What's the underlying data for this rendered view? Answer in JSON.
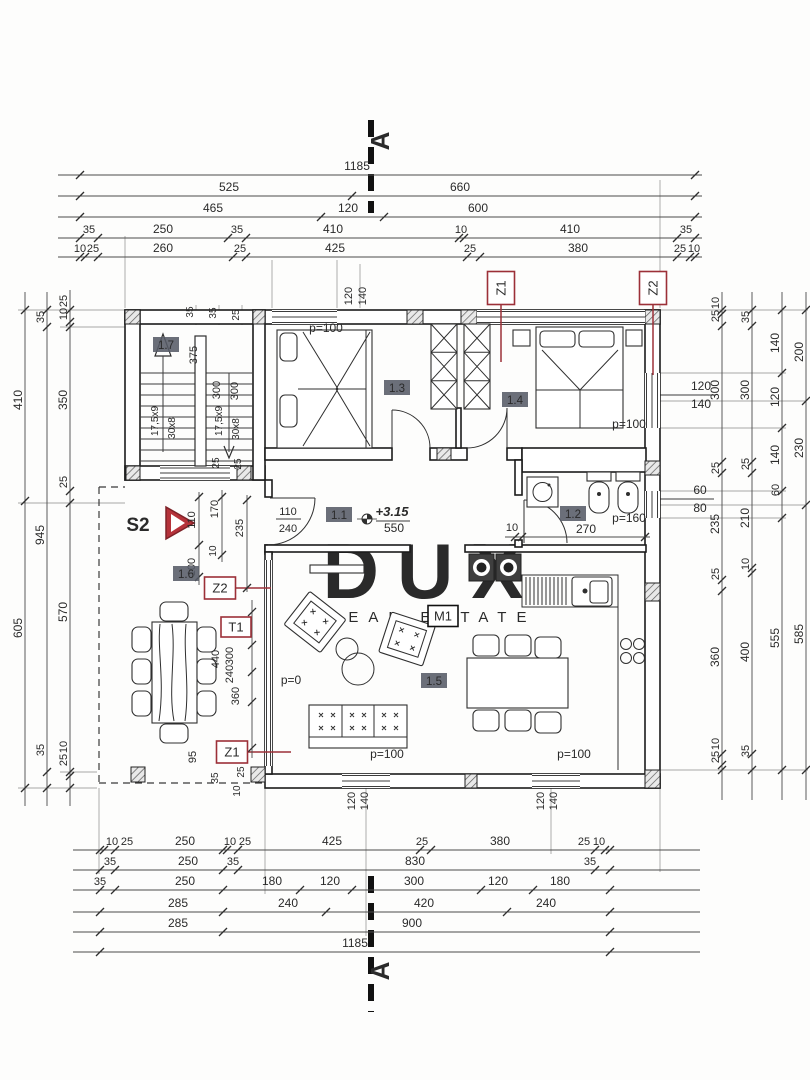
{
  "watermark": {
    "line1": "DUX",
    "line2": "REAL ESTATE"
  },
  "colors": {
    "red": "#9c3038",
    "badge_bg": "#565b66",
    "wall": "#1c1c1c"
  },
  "section_marker": "A",
  "rooms": [
    {
      "id": "1.7",
      "x": 166,
      "y": 348
    },
    {
      "id": "1.3",
      "x": 397,
      "y": 391
    },
    {
      "id": "1.4",
      "x": 515,
      "y": 403
    },
    {
      "id": "1.1",
      "x": 339,
      "y": 518
    },
    {
      "id": "1.2",
      "x": 573,
      "y": 517
    },
    {
      "id": "1.5",
      "x": 434,
      "y": 684
    },
    {
      "id": "1.6",
      "x": 186,
      "y": 577
    }
  ],
  "marker_boxes": [
    {
      "t": "Z1",
      "x": 501,
      "y": 288,
      "w": 27,
      "h": 33,
      "r": -90,
      "style": "red"
    },
    {
      "t": "Z2",
      "x": 653,
      "y": 288,
      "w": 27,
      "h": 33,
      "r": -90,
      "style": "red"
    },
    {
      "t": "Z2",
      "x": 220,
      "y": 588,
      "w": 31,
      "h": 22,
      "r": 0,
      "style": "red"
    },
    {
      "t": "T1",
      "x": 236,
      "y": 627,
      "w": 30,
      "h": 20,
      "r": 0,
      "style": "red"
    },
    {
      "t": "Z1",
      "x": 232,
      "y": 752,
      "w": 31,
      "h": 22,
      "r": 0,
      "style": "red"
    },
    {
      "t": "M1",
      "x": 443,
      "y": 616,
      "w": 30,
      "h": 21,
      "r": 0,
      "style": "black"
    }
  ],
  "s2_label": "S2",
  "labels": [
    {
      "t": "A",
      "x": 389,
      "y": 141,
      "r": -90,
      "s": 26,
      "b": 1
    },
    {
      "t": "A",
      "x": 389,
      "y": 971,
      "r": -90,
      "s": 26,
      "b": 1
    },
    {
      "t": "1185",
      "x": 357,
      "y": 170,
      "s": 12
    },
    {
      "t": "525",
      "x": 229,
      "y": 191,
      "s": 12
    },
    {
      "t": "660",
      "x": 460,
      "y": 191,
      "s": 12
    },
    {
      "t": "465",
      "x": 213,
      "y": 212,
      "s": 12
    },
    {
      "t": "120",
      "x": 348,
      "y": 212,
      "s": 12
    },
    {
      "t": "600",
      "x": 478,
      "y": 212,
      "s": 12
    },
    {
      "t": "35",
      "x": 89,
      "y": 233,
      "s": 11
    },
    {
      "t": "250",
      "x": 163,
      "y": 233,
      "s": 12
    },
    {
      "t": "35",
      "x": 237,
      "y": 233,
      "s": 11
    },
    {
      "t": "410",
      "x": 333,
      "y": 233,
      "s": 12
    },
    {
      "t": "10",
      "x": 461,
      "y": 233,
      "s": 11
    },
    {
      "t": "410",
      "x": 570,
      "y": 233,
      "s": 12
    },
    {
      "t": "35",
      "x": 686,
      "y": 233,
      "s": 11
    },
    {
      "t": "10",
      "x": 80,
      "y": 252,
      "s": 11
    },
    {
      "t": "25",
      "x": 93,
      "y": 252,
      "s": 11
    },
    {
      "t": "260",
      "x": 163,
      "y": 252,
      "s": 12
    },
    {
      "t": "25",
      "x": 240,
      "y": 252,
      "s": 11
    },
    {
      "t": "425",
      "x": 335,
      "y": 252,
      "s": 12
    },
    {
      "t": "25",
      "x": 470,
      "y": 252,
      "s": 11
    },
    {
      "t": "380",
      "x": 578,
      "y": 252,
      "s": 12
    },
    {
      "t": "25",
      "x": 680,
      "y": 252,
      "s": 11
    },
    {
      "t": "10",
      "x": 694,
      "y": 252,
      "s": 11
    },
    {
      "t": "120",
      "x": 352,
      "y": 296,
      "r": -90,
      "s": 11
    },
    {
      "t": "140",
      "x": 366,
      "y": 296,
      "r": -90,
      "s": 11
    },
    {
      "t": "10",
      "x": 112,
      "y": 845,
      "s": 11
    },
    {
      "t": "25",
      "x": 127,
      "y": 845,
      "s": 11
    },
    {
      "t": "250",
      "x": 185,
      "y": 845,
      "s": 12
    },
    {
      "t": "10",
      "x": 230,
      "y": 845,
      "s": 11
    },
    {
      "t": "25",
      "x": 245,
      "y": 845,
      "s": 11
    },
    {
      "t": "425",
      "x": 332,
      "y": 845,
      "s": 12
    },
    {
      "t": "25",
      "x": 422,
      "y": 845,
      "s": 11
    },
    {
      "t": "380",
      "x": 500,
      "y": 845,
      "s": 12
    },
    {
      "t": "25",
      "x": 584,
      "y": 845,
      "s": 11
    },
    {
      "t": "10",
      "x": 599,
      "y": 845,
      "s": 11
    },
    {
      "t": "35",
      "x": 110,
      "y": 865,
      "s": 11
    },
    {
      "t": "250",
      "x": 188,
      "y": 865,
      "s": 12
    },
    {
      "t": "35",
      "x": 233,
      "y": 865,
      "s": 11
    },
    {
      "t": "830",
      "x": 415,
      "y": 865,
      "s": 12
    },
    {
      "t": "35",
      "x": 590,
      "y": 865,
      "s": 11
    },
    {
      "t": "35",
      "x": 100,
      "y": 885,
      "s": 11
    },
    {
      "t": "250",
      "x": 185,
      "y": 885,
      "s": 12
    },
    {
      "t": "180",
      "x": 272,
      "y": 885,
      "s": 12
    },
    {
      "t": "120",
      "x": 330,
      "y": 885,
      "s": 12
    },
    {
      "t": "300",
      "x": 414,
      "y": 885,
      "s": 12
    },
    {
      "t": "120",
      "x": 498,
      "y": 885,
      "s": 12
    },
    {
      "t": "180",
      "x": 560,
      "y": 885,
      "s": 12
    },
    {
      "t": "285",
      "x": 178,
      "y": 907,
      "s": 12
    },
    {
      "t": "240",
      "x": 288,
      "y": 907,
      "s": 12
    },
    {
      "t": "420",
      "x": 424,
      "y": 907,
      "s": 12
    },
    {
      "t": "240",
      "x": 546,
      "y": 907,
      "s": 12
    },
    {
      "t": "285",
      "x": 178,
      "y": 927,
      "s": 12
    },
    {
      "t": "900",
      "x": 412,
      "y": 927,
      "s": 12
    },
    {
      "t": "1185",
      "x": 355,
      "y": 947,
      "s": 12
    },
    {
      "t": "120",
      "x": 355,
      "y": 801,
      "r": -90,
      "s": 11
    },
    {
      "t": "140",
      "x": 368,
      "y": 801,
      "r": -90,
      "s": 11
    },
    {
      "t": "120",
      "x": 544,
      "y": 801,
      "r": -90,
      "s": 11
    },
    {
      "t": "140",
      "x": 557,
      "y": 801,
      "r": -90,
      "s": 11
    },
    {
      "t": "410",
      "x": 22,
      "y": 400,
      "r": -90,
      "s": 12
    },
    {
      "t": "605",
      "x": 22,
      "y": 628,
      "r": -90,
      "s": 12
    },
    {
      "t": "35",
      "x": 44,
      "y": 317,
      "r": -90,
      "s": 11
    },
    {
      "t": "945",
      "x": 44,
      "y": 535,
      "r": -90,
      "s": 12
    },
    {
      "t": "35",
      "x": 44,
      "y": 750,
      "r": -90,
      "s": 11
    },
    {
      "t": "25",
      "x": 67,
      "y": 301,
      "r": -90,
      "s": 11
    },
    {
      "t": "10",
      "x": 67,
      "y": 314,
      "r": -90,
      "s": 11
    },
    {
      "t": "350",
      "x": 67,
      "y": 400,
      "r": -90,
      "s": 12
    },
    {
      "t": "25",
      "x": 67,
      "y": 482,
      "r": -90,
      "s": 11
    },
    {
      "t": "570",
      "x": 67,
      "y": 612,
      "r": -90,
      "s": 12
    },
    {
      "t": "10",
      "x": 67,
      "y": 747,
      "r": -90,
      "s": 11
    },
    {
      "t": "25",
      "x": 67,
      "y": 760,
      "r": -90,
      "s": 11
    },
    {
      "t": "10",
      "x": 719,
      "y": 303,
      "r": -90,
      "s": 11
    },
    {
      "t": "25",
      "x": 719,
      "y": 316,
      "r": -90,
      "s": 11
    },
    {
      "t": "300",
      "x": 719,
      "y": 390,
      "r": -90,
      "s": 12
    },
    {
      "t": "25",
      "x": 719,
      "y": 468,
      "r": -90,
      "s": 11
    },
    {
      "t": "235",
      "x": 719,
      "y": 524,
      "r": -90,
      "s": 12
    },
    {
      "t": "25",
      "x": 719,
      "y": 574,
      "r": -90,
      "s": 11
    },
    {
      "t": "360",
      "x": 719,
      "y": 657,
      "r": -90,
      "s": 12
    },
    {
      "t": "10",
      "x": 719,
      "y": 744,
      "r": -90,
      "s": 11
    },
    {
      "t": "25",
      "x": 719,
      "y": 757,
      "r": -90,
      "s": 11
    },
    {
      "t": "35",
      "x": 749,
      "y": 317,
      "r": -90,
      "s": 11
    },
    {
      "t": "300",
      "x": 749,
      "y": 390,
      "r": -90,
      "s": 12
    },
    {
      "t": "25",
      "x": 749,
      "y": 464,
      "r": -90,
      "s": 11
    },
    {
      "t": "210",
      "x": 749,
      "y": 518,
      "r": -90,
      "s": 12
    },
    {
      "t": "10",
      "x": 749,
      "y": 564,
      "r": -90,
      "s": 11
    },
    {
      "t": "400",
      "x": 749,
      "y": 652,
      "r": -90,
      "s": 12
    },
    {
      "t": "35",
      "x": 749,
      "y": 751,
      "r": -90,
      "s": 11
    },
    {
      "t": "140",
      "x": 779,
      "y": 343,
      "r": -90,
      "s": 12
    },
    {
      "t": "120",
      "x": 779,
      "y": 397,
      "r": -90,
      "s": 12
    },
    {
      "t": "140",
      "x": 779,
      "y": 455,
      "r": -90,
      "s": 12
    },
    {
      "t": "60",
      "x": 779,
      "y": 490,
      "r": -90,
      "s": 11
    },
    {
      "t": "555",
      "x": 779,
      "y": 638,
      "r": -90,
      "s": 12
    },
    {
      "t": "200",
      "x": 803,
      "y": 352,
      "r": -90,
      "s": 12
    },
    {
      "t": "230",
      "x": 803,
      "y": 448,
      "r": -90,
      "s": 12
    },
    {
      "t": "585",
      "x": 803,
      "y": 634,
      "r": -90,
      "s": 12
    },
    {
      "t": "120",
      "x": 701,
      "y": 390,
      "s": 12
    },
    {
      "t": "140",
      "x": 701,
      "y": 408,
      "s": 12
    },
    {
      "t": "60",
      "x": 700,
      "y": 494,
      "s": 12
    },
    {
      "t": "80",
      "x": 700,
      "y": 512,
      "s": 12
    },
    {
      "t": "p=100",
      "x": 326,
      "y": 332,
      "s": 12
    },
    {
      "t": "p=100",
      "x": 629,
      "y": 428,
      "s": 12
    },
    {
      "t": "p=100",
      "x": 387,
      "y": 758,
      "s": 12
    },
    {
      "t": "p=100",
      "x": 574,
      "y": 758,
      "s": 12
    },
    {
      "t": "p=160",
      "x": 629,
      "y": 522,
      "s": 12
    },
    {
      "t": "p=0",
      "x": 291,
      "y": 684,
      "s": 12
    },
    {
      "t": "270",
      "x": 586,
      "y": 533,
      "s": 12
    },
    {
      "t": "10",
      "x": 512,
      "y": 531,
      "s": 11
    },
    {
      "t": "550",
      "x": 394,
      "y": 532,
      "s": 12
    },
    {
      "t": "+3.15",
      "x": 392,
      "y": 516,
      "s": 13,
      "i": 1
    },
    {
      "t": "110",
      "x": 288,
      "y": 515,
      "s": 11
    },
    {
      "t": "240",
      "x": 288,
      "y": 532,
      "s": 11
    },
    {
      "t": "375",
      "x": 197,
      "y": 355,
      "r": -90,
      "s": 11
    },
    {
      "t": "35",
      "x": 193,
      "y": 312,
      "r": -90,
      "s": 10
    },
    {
      "t": "35",
      "x": 216,
      "y": 313,
      "r": -90,
      "s": 10
    },
    {
      "t": "25",
      "x": 239,
      "y": 315,
      "r": -90,
      "s": 10
    },
    {
      "t": "300",
      "x": 220,
      "y": 390,
      "r": -90,
      "s": 11
    },
    {
      "t": "300",
      "x": 238,
      "y": 391,
      "r": -90,
      "s": 11
    },
    {
      "t": "25",
      "x": 219,
      "y": 463,
      "r": -90,
      "s": 10
    },
    {
      "t": "25",
      "x": 241,
      "y": 464,
      "r": -90,
      "s": 10
    },
    {
      "t": "17,5x9",
      "x": 158,
      "y": 421,
      "r": -90,
      "s": 10
    },
    {
      "t": "30x8",
      "x": 175,
      "y": 428,
      "r": -90,
      "s": 10
    },
    {
      "t": "17,5x9",
      "x": 222,
      "y": 421,
      "r": -90,
      "s": 10
    },
    {
      "t": "30x8",
      "x": 239,
      "y": 429,
      "r": -90,
      "s": 10
    },
    {
      "t": "110",
      "x": 195,
      "y": 520,
      "r": -90,
      "s": 11
    },
    {
      "t": "170",
      "x": 218,
      "y": 509,
      "r": -90,
      "s": 11
    },
    {
      "t": "235",
      "x": 243,
      "y": 528,
      "r": -90,
      "s": 11
    },
    {
      "t": "10",
      "x": 216,
      "y": 551,
      "r": -90,
      "s": 10
    },
    {
      "t": "100",
      "x": 195,
      "y": 567,
      "r": -90,
      "s": 11
    },
    {
      "t": "440",
      "x": 219,
      "y": 659,
      "r": -90,
      "s": 11
    },
    {
      "t": "300",
      "x": 233,
      "y": 656,
      "r": -90,
      "s": 11
    },
    {
      "t": "240",
      "x": 233,
      "y": 674,
      "r": -90,
      "s": 11
    },
    {
      "t": "360",
      "x": 239,
      "y": 696,
      "r": -90,
      "s": 11
    },
    {
      "t": "95",
      "x": 196,
      "y": 757,
      "r": -90,
      "s": 11
    },
    {
      "t": "35",
      "x": 218,
      "y": 778,
      "r": -90,
      "s": 10
    },
    {
      "t": "25",
      "x": 244,
      "y": 772,
      "r": -90,
      "s": 10
    },
    {
      "t": "10",
      "x": 240,
      "y": 791,
      "r": -90,
      "s": 10
    }
  ],
  "chains": [
    {
      "o": "h",
      "y": 175,
      "x1": 58,
      "x2": 702,
      "ticks": [
        80,
        695
      ]
    },
    {
      "o": "h",
      "y": 196,
      "x1": 58,
      "x2": 702,
      "ticks": [
        80,
        352,
        695
      ]
    },
    {
      "o": "h",
      "y": 217,
      "x1": 58,
      "x2": 702,
      "ticks": [
        80,
        321,
        384,
        695
      ]
    },
    {
      "o": "h",
      "y": 238,
      "x1": 58,
      "x2": 702,
      "ticks": [
        80,
        98,
        228,
        246,
        459,
        464,
        677,
        695
      ]
    },
    {
      "o": "h",
      "y": 257,
      "x1": 58,
      "x2": 702,
      "ticks": [
        80,
        85,
        98,
        233,
        246,
        467,
        480,
        677,
        690,
        695
      ]
    },
    {
      "o": "h",
      "y": 850,
      "x1": 73,
      "x2": 700,
      "ticks": [
        100,
        104,
        115,
        223,
        227,
        238,
        420,
        431,
        595,
        605,
        610
      ]
    },
    {
      "o": "h",
      "y": 870,
      "x1": 73,
      "x2": 700,
      "ticks": [
        100,
        115,
        223,
        238,
        595,
        610
      ]
    },
    {
      "o": "h",
      "y": 890,
      "x1": 73,
      "x2": 700,
      "ticks": [
        100,
        115,
        223,
        300,
        352,
        481,
        533,
        610
      ]
    },
    {
      "o": "h",
      "y": 912,
      "x1": 73,
      "x2": 700,
      "ticks": [
        100,
        223,
        326,
        507,
        610
      ]
    },
    {
      "o": "h",
      "y": 932,
      "x1": 73,
      "x2": 700,
      "ticks": [
        100,
        223,
        610
      ]
    },
    {
      "o": "h",
      "y": 952,
      "x1": 73,
      "x2": 700,
      "ticks": [
        100,
        610
      ]
    },
    {
      "o": "h",
      "y": 537,
      "x1": 505,
      "x2": 650,
      "ticks": [
        515,
        522,
        645
      ]
    },
    {
      "o": "v",
      "x": 25,
      "y1": 292,
      "y2": 806,
      "ticks": [
        310,
        501,
        788
      ]
    },
    {
      "o": "v",
      "x": 47,
      "y1": 292,
      "y2": 806,
      "ticks": [
        310,
        327,
        772,
        788
      ]
    },
    {
      "o": "v",
      "x": 70,
      "y1": 290,
      "y2": 806,
      "ticks": [
        310,
        322,
        327,
        491,
        503,
        772,
        776,
        788
      ]
    },
    {
      "o": "v",
      "x": 722,
      "y1": 292,
      "y2": 800,
      "ticks": [
        310,
        314,
        326,
        462,
        473,
        580,
        591,
        754,
        765,
        770
      ]
    },
    {
      "o": "v",
      "x": 752,
      "y1": 292,
      "y2": 800,
      "ticks": [
        310,
        326,
        462,
        473,
        568,
        573,
        754,
        770
      ]
    },
    {
      "o": "v",
      "x": 782,
      "y1": 292,
      "y2": 800,
      "ticks": [
        310,
        373,
        428,
        491,
        518,
        770
      ]
    },
    {
      "o": "v",
      "x": 806,
      "y1": 292,
      "y2": 800,
      "ticks": [
        310,
        401,
        505,
        770
      ]
    },
    {
      "o": "v",
      "x": 199,
      "y1": 492,
      "y2": 585,
      "ticks": [
        497,
        545,
        577
      ]
    },
    {
      "o": "v",
      "x": 222,
      "y1": 490,
      "y2": 562,
      "ticks": [
        497,
        555
      ]
    },
    {
      "o": "v",
      "x": 247,
      "y1": 495,
      "y2": 592,
      "ticks": [
        500,
        588
      ]
    },
    {
      "o": "v",
      "x": 252,
      "y1": 600,
      "y2": 758,
      "ticks": [
        612,
        645,
        672,
        702,
        748
      ]
    }
  ]
}
